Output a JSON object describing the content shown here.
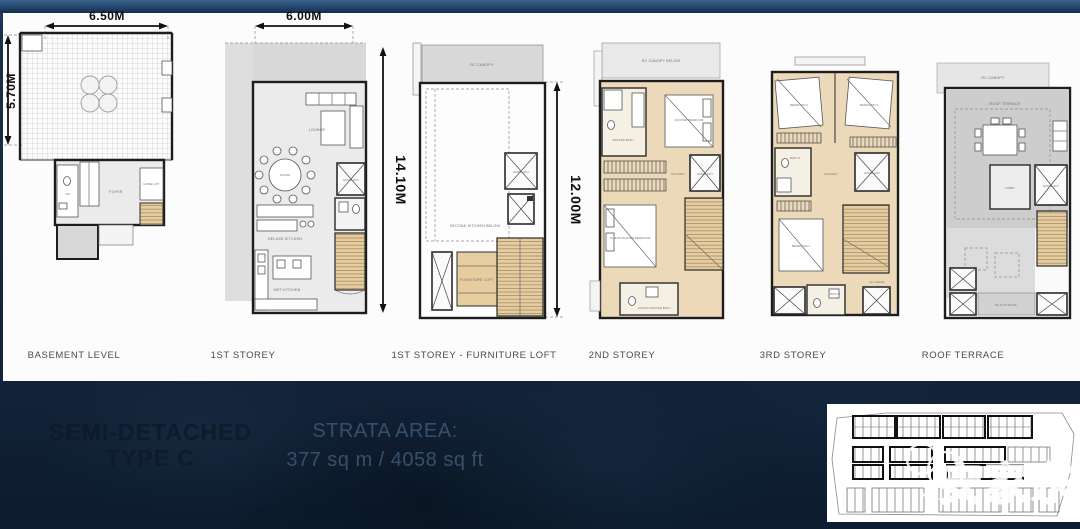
{
  "plans": [
    {
      "label": "BASEMENT LEVEL",
      "dim_width": "6.50M",
      "dim_height": "5.70M",
      "rooms": {
        "wc": "WC",
        "foyer": "FOYER",
        "lift": "HOME LIFT"
      }
    },
    {
      "label": "1ST STOREY",
      "dim_width": "6.00M",
      "dim_height": "14.10M",
      "rooms": {
        "lounge": "LOUNGE",
        "dining": "DINING",
        "kitchen": "DELUXE KITCHEN",
        "wet_kitchen": "WET KITCHEN",
        "lift": "HOME LIFT"
      }
    },
    {
      "label": "1ST STOREY - FURNITURE LOFT",
      "dim_height": "12.00M",
      "rooms": {
        "canopy": "RC CANOPY",
        "second_kitchen": "SECOND KITCHEN BELOW",
        "loft": "FURNITURE LOFT",
        "lift": "HOME LIFT"
      }
    },
    {
      "label": "2ND STOREY",
      "rooms": {
        "canopy": "RC CANOPY BELOW",
        "master_bath": "MASTER BATH",
        "master_bed": "MASTER BEDROOM",
        "hallway": "HALLWAY",
        "lift": "HOME LIFT",
        "junior_bed": "JUNIOR MASTER BEDROOM",
        "junior_bath": "JUNIOR MASTER BATH"
      }
    },
    {
      "label": "3RD STOREY",
      "rooms": {
        "bed2": "BEDROOM 2",
        "bed3": "BEDROOM 3",
        "bath2": "BATH 2",
        "hallway": "HALLWAY",
        "lift": "HOME LIFT",
        "bed4": "BEDROOM 4",
        "bath3": "BATH 3",
        "ac": "AC LEDGE"
      }
    },
    {
      "label": "ROOF TERRACE",
      "rooms": {
        "canopy": "RC CANOPY",
        "terrace": "ROOF TERRACE",
        "lobby": "LOBBY",
        "lift": "HOME LIFT",
        "flat_roof": "RC FLAT ROOF"
      }
    }
  ],
  "footer": {
    "title_line1": "SEMI-DETACHED",
    "title_line2": "TYPE C",
    "strata_label": "STRATA AREA:",
    "strata_value": "377 sq m / 4058 sq ft"
  },
  "watermark": {
    "text": "安家东明"
  },
  "colors": {
    "bg_navy": "#16293e",
    "panel": "#fcfcfc",
    "floor_tan": "#ecd9ba",
    "wall": "#1d1d1d"
  }
}
